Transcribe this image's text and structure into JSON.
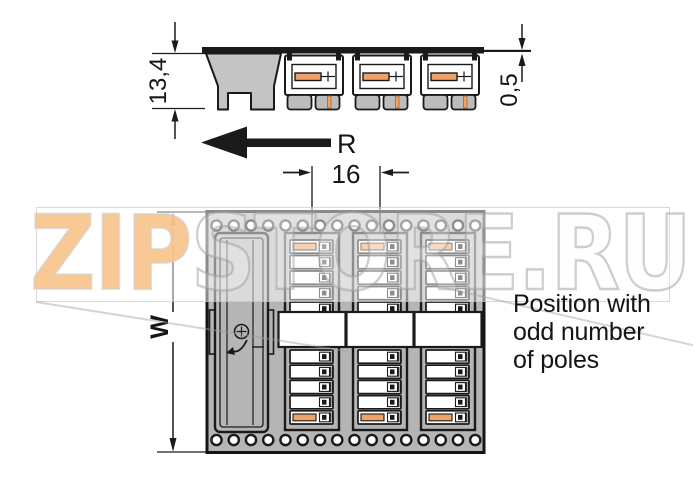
{
  "drawing": {
    "type": "connector technical drawing",
    "views": [
      "side view",
      "top view"
    ]
  },
  "dimensions": {
    "height_label": "13,4",
    "solder_pin_label": "0,5",
    "pitch_label": "16",
    "width_label": "W",
    "direction_label": "R"
  },
  "caption": {
    "line1": "Position with",
    "line2": "odd number",
    "line3": "of poles"
  },
  "watermark": {
    "part1": "ZIP",
    "part2": "STORE.RU"
  },
  "side_view": {
    "module_count": 3,
    "module_x": [
      284,
      352,
      420
    ]
  },
  "top_view": {
    "strip_count": 3,
    "strip_centers": [
      312,
      380,
      448
    ],
    "slots_per_strip": 10,
    "orange_slot_indexes": [
      0,
      9
    ],
    "holes_per_row": 16,
    "hole_rows": 2
  },
  "colors": {
    "line": "#1a1a1a",
    "board_gray": "#b5b5b5",
    "end_module_gray": "#c4c4c4",
    "feet_gray": "#bcbcbc",
    "contact_orange": "#f1a266",
    "watermark_orange": "#f8c38c",
    "watermark_gray": "#9a9a9a"
  }
}
